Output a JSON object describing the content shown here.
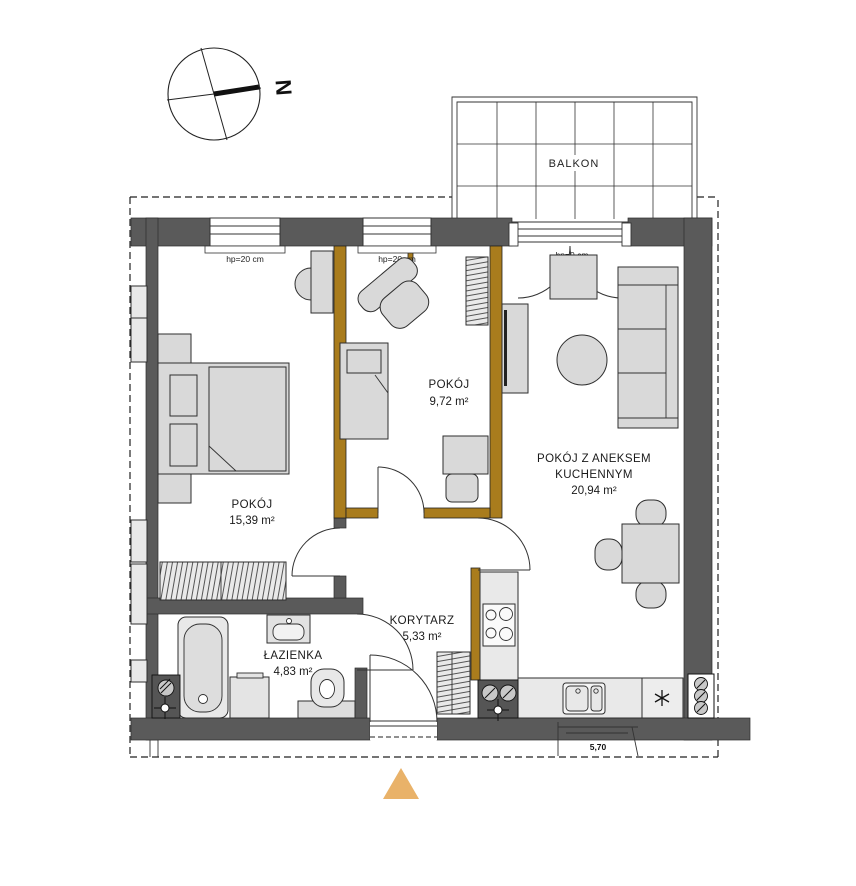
{
  "compass": {
    "north_label": "N"
  },
  "balcony": {
    "label": "BALKON"
  },
  "rooms": {
    "small_room": {
      "name": "POKÓJ",
      "area": "9,72 m²"
    },
    "bedroom": {
      "name": "POKÓJ",
      "area": "15,39 m²"
    },
    "living_kitchen": {
      "name_line1": "POKÓJ Z ANEKSEM",
      "name_line2": "KUCHENNYM",
      "area": "20,94 m²"
    },
    "corridor": {
      "name": "KORYTARZ",
      "area": "5,33 m²"
    },
    "bathroom": {
      "name": "ŁAZIENKA",
      "area": "4,83 m²"
    }
  },
  "openings": {
    "window_1": {
      "label": "hp=20 cm"
    },
    "window_2": {
      "label": "hp=20 cm"
    },
    "balcony_door": {
      "label": "hp=0 cm"
    }
  },
  "annotations": {
    "neighbor_partial_dimension": "5,70"
  },
  "icons": {
    "compass_north": "circle-crosshair-needle",
    "entrance_marker": "orange-triangle-up",
    "fridge_symbol": "asterisk",
    "plumbing_riser": "hatched-circle",
    "survey_cross": "crosshair-circle"
  },
  "colors": {
    "wall": "#5a5a5a",
    "partition": "#a97c1d",
    "furniture_fill": "#d9d9d9",
    "entrance_marker": "#e9b269"
  }
}
